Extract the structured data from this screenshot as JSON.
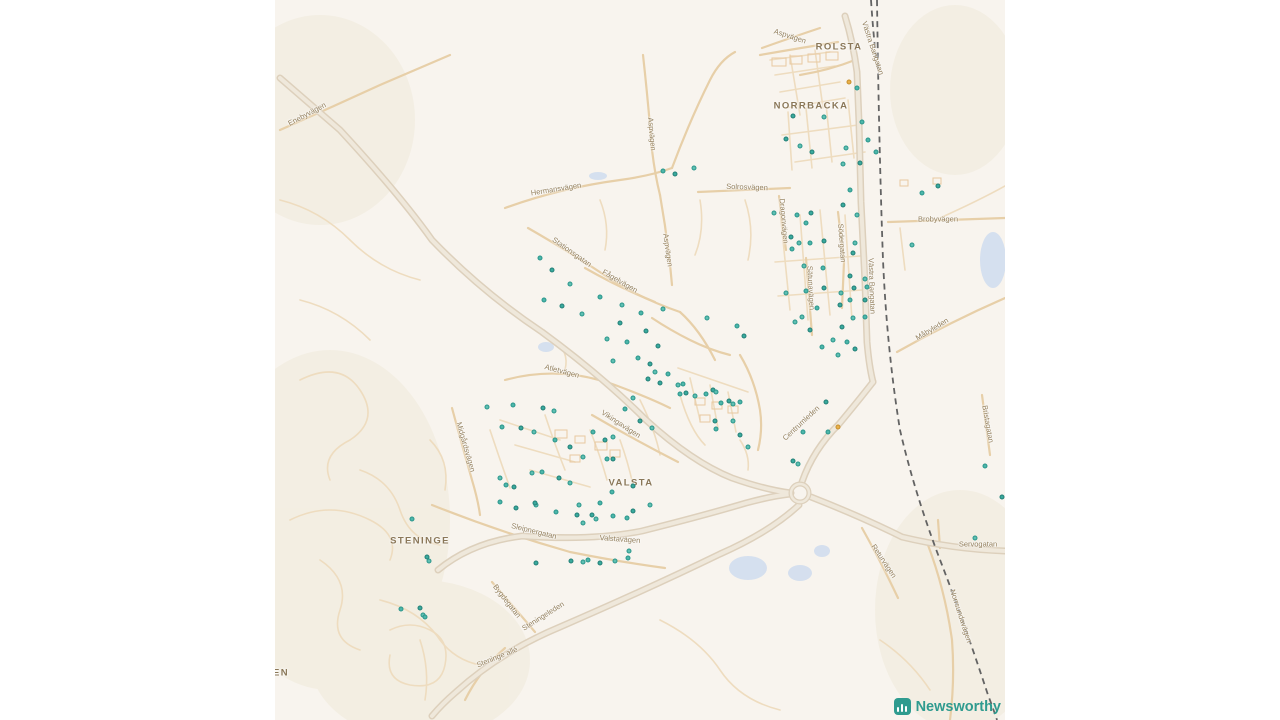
{
  "map": {
    "background_color": "#f8f4ee",
    "road_color": "#e7cfa8",
    "major_road_color": "#ddd0bc",
    "railway_color": "#606060",
    "water_color": "#cfdcef",
    "marker_teal": "#4db6aa",
    "marker_orange": "#e9b04a",
    "place_labels": [
      {
        "text": "ROLSTA",
        "x": 839,
        "y": 47
      },
      {
        "text": "NORRBACKA",
        "x": 811,
        "y": 106
      },
      {
        "text": "VALSTA",
        "x": 631,
        "y": 483
      },
      {
        "text": "STENINGE",
        "x": 420,
        "y": 541
      },
      {
        "text": "EN",
        "x": 281,
        "y": 673
      }
    ],
    "street_labels": [
      {
        "text": "Aspvägen",
        "x": 790,
        "y": 36,
        "rot": 18
      },
      {
        "text": "Västra Bangatan",
        "x": 873,
        "y": 48,
        "rot": 72
      },
      {
        "text": "Enebyvägen",
        "x": 307,
        "y": 114,
        "rot": -28
      },
      {
        "text": "Hermansvägen",
        "x": 556,
        "y": 189,
        "rot": -9
      },
      {
        "text": "Solrosvägen",
        "x": 747,
        "y": 187,
        "rot": 2
      },
      {
        "text": "Stationsgatan",
        "x": 572,
        "y": 252,
        "rot": 35
      },
      {
        "text": "Fågelvägen",
        "x": 620,
        "y": 281,
        "rot": 30
      },
      {
        "text": "Aspvägen",
        "x": 652,
        "y": 134,
        "rot": 85
      },
      {
        "text": "Aspvägen",
        "x": 668,
        "y": 250,
        "rot": 82
      },
      {
        "text": "Dragonvägen",
        "x": 784,
        "y": 221,
        "rot": 85
      },
      {
        "text": "Södergatan",
        "x": 842,
        "y": 243,
        "rot": 86
      },
      {
        "text": "Sätunavägen",
        "x": 811,
        "y": 288,
        "rot": 87
      },
      {
        "text": "Västra Bangatan",
        "x": 872,
        "y": 286,
        "rot": 88
      },
      {
        "text": "Brobyvägen",
        "x": 938,
        "y": 219,
        "rot": 0
      },
      {
        "text": "Måbyleden",
        "x": 932,
        "y": 329,
        "rot": -31
      },
      {
        "text": "Bristagatan",
        "x": 988,
        "y": 424,
        "rot": 80
      },
      {
        "text": "Centrumleden",
        "x": 801,
        "y": 423,
        "rot": -43
      },
      {
        "text": "Midgårdsvägen",
        "x": 466,
        "y": 447,
        "rot": 74
      },
      {
        "text": "Atletvägen",
        "x": 562,
        "y": 371,
        "rot": 15
      },
      {
        "text": "Vikingavägen",
        "x": 621,
        "y": 424,
        "rot": 33
      },
      {
        "text": "Valstavägen",
        "x": 620,
        "y": 539,
        "rot": 4
      },
      {
        "text": "Sleipnergatan",
        "x": 534,
        "y": 531,
        "rot": 14
      },
      {
        "text": "Bygdegatan",
        "x": 507,
        "y": 601,
        "rot": 52
      },
      {
        "text": "Steningeleden",
        "x": 543,
        "y": 616,
        "rot": -32
      },
      {
        "text": "Steninge allé",
        "x": 497,
        "y": 657,
        "rot": -22
      },
      {
        "text": "Servogatan",
        "x": 978,
        "y": 544,
        "rot": 0
      },
      {
        "text": "Returvägen",
        "x": 884,
        "y": 561,
        "rot": 56
      },
      {
        "text": "Norrsundavägen",
        "x": 961,
        "y": 616,
        "rot": 72
      }
    ],
    "orange_dots": [
      [
        849,
        82
      ],
      [
        838,
        427
      ]
    ],
    "dots": [
      [
        857,
        88
      ],
      [
        793,
        116
      ],
      [
        824,
        117
      ],
      [
        862,
        122
      ],
      [
        786,
        139
      ],
      [
        800,
        146
      ],
      [
        868,
        140
      ],
      [
        812,
        152
      ],
      [
        846,
        148
      ],
      [
        876,
        152
      ],
      [
        860,
        163
      ],
      [
        843,
        164
      ],
      [
        663,
        171
      ],
      [
        675,
        174
      ],
      [
        694,
        168
      ],
      [
        922,
        193
      ],
      [
        938,
        186
      ],
      [
        912,
        245
      ],
      [
        850,
        190
      ],
      [
        843,
        205
      ],
      [
        774,
        213
      ],
      [
        797,
        215
      ],
      [
        811,
        213
      ],
      [
        857,
        215
      ],
      [
        806,
        223
      ],
      [
        791,
        237
      ],
      [
        799,
        243
      ],
      [
        810,
        243
      ],
      [
        824,
        241
      ],
      [
        855,
        243
      ],
      [
        792,
        249
      ],
      [
        853,
        253
      ],
      [
        804,
        266
      ],
      [
        823,
        268
      ],
      [
        850,
        276
      ],
      [
        865,
        279
      ],
      [
        867,
        287
      ],
      [
        854,
        288
      ],
      [
        786,
        293
      ],
      [
        806,
        291
      ],
      [
        824,
        288
      ],
      [
        841,
        293
      ],
      [
        850,
        300
      ],
      [
        865,
        300
      ],
      [
        802,
        317
      ],
      [
        817,
        308
      ],
      [
        840,
        305
      ],
      [
        853,
        318
      ],
      [
        865,
        317
      ],
      [
        842,
        327
      ],
      [
        833,
        340
      ],
      [
        847,
        342
      ],
      [
        855,
        349
      ],
      [
        838,
        355
      ],
      [
        822,
        347
      ],
      [
        810,
        330
      ],
      [
        795,
        322
      ],
      [
        540,
        258
      ],
      [
        552,
        270
      ],
      [
        570,
        284
      ],
      [
        544,
        300
      ],
      [
        562,
        306
      ],
      [
        582,
        314
      ],
      [
        600,
        297
      ],
      [
        620,
        323
      ],
      [
        607,
        339
      ],
      [
        627,
        342
      ],
      [
        646,
        331
      ],
      [
        663,
        309
      ],
      [
        638,
        358
      ],
      [
        650,
        364
      ],
      [
        622,
        305
      ],
      [
        641,
        313
      ],
      [
        658,
        346
      ],
      [
        613,
        361
      ],
      [
        683,
        384
      ],
      [
        686,
        393
      ],
      [
        695,
        396
      ],
      [
        706,
        394
      ],
      [
        713,
        390
      ],
      [
        716,
        392
      ],
      [
        721,
        403
      ],
      [
        729,
        401
      ],
      [
        733,
        404
      ],
      [
        740,
        402
      ],
      [
        715,
        421
      ],
      [
        733,
        421
      ],
      [
        716,
        429
      ],
      [
        740,
        435
      ],
      [
        748,
        447
      ],
      [
        803,
        432
      ],
      [
        793,
        461
      ],
      [
        798,
        464
      ],
      [
        828,
        432
      ],
      [
        826,
        402
      ],
      [
        707,
        318
      ],
      [
        737,
        326
      ],
      [
        744,
        336
      ],
      [
        487,
        407
      ],
      [
        513,
        405
      ],
      [
        543,
        408
      ],
      [
        554,
        411
      ],
      [
        502,
        427
      ],
      [
        521,
        428
      ],
      [
        534,
        432
      ],
      [
        555,
        440
      ],
      [
        570,
        447
      ],
      [
        583,
        457
      ],
      [
        593,
        432
      ],
      [
        605,
        440
      ],
      [
        613,
        437
      ],
      [
        607,
        459
      ],
      [
        613,
        459
      ],
      [
        500,
        478
      ],
      [
        506,
        485
      ],
      [
        514,
        487
      ],
      [
        532,
        473
      ],
      [
        542,
        472
      ],
      [
        559,
        478
      ],
      [
        570,
        483
      ],
      [
        612,
        492
      ],
      [
        633,
        486
      ],
      [
        655,
        372
      ],
      [
        668,
        374
      ],
      [
        660,
        383
      ],
      [
        678,
        385
      ],
      [
        680,
        394
      ],
      [
        648,
        379
      ],
      [
        633,
        398
      ],
      [
        625,
        409
      ],
      [
        640,
        421
      ],
      [
        652,
        428
      ],
      [
        500,
        502
      ],
      [
        516,
        508
      ],
      [
        536,
        505
      ],
      [
        556,
        512
      ],
      [
        577,
        515
      ],
      [
        596,
        519
      ],
      [
        613,
        516
      ],
      [
        633,
        511
      ],
      [
        650,
        505
      ],
      [
        412,
        519
      ],
      [
        427,
        557
      ],
      [
        429,
        561
      ],
      [
        401,
        609
      ],
      [
        420,
        608
      ],
      [
        423,
        615
      ],
      [
        425,
        617
      ],
      [
        535,
        503
      ],
      [
        579,
        505
      ],
      [
        600,
        503
      ],
      [
        592,
        515
      ],
      [
        583,
        523
      ],
      [
        627,
        518
      ],
      [
        571,
        561
      ],
      [
        583,
        562
      ],
      [
        588,
        560
      ],
      [
        600,
        563
      ],
      [
        615,
        561
      ],
      [
        628,
        558
      ],
      [
        536,
        563
      ],
      [
        629,
        551
      ],
      [
        985,
        466
      ],
      [
        1002,
        497
      ],
      [
        975,
        538
      ]
    ],
    "attribution": {
      "label": "Newsworthy",
      "icon": "bar-chart-icon",
      "brand_color": "#2f9b8f"
    }
  }
}
